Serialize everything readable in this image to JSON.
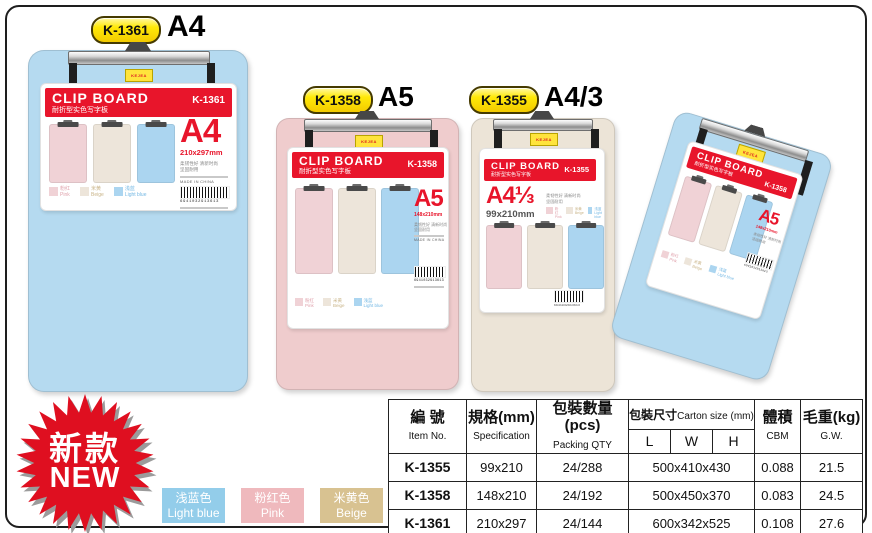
{
  "brand": {
    "logo_text": "KEJEA"
  },
  "products": [
    {
      "badge": "K-1361",
      "size_label": "A4",
      "board_color": "#b5daf0",
      "label": {
        "title": "CLIP BOARD",
        "subtitle": "耐折型实色写字板",
        "code": "K-1361",
        "size": "A4",
        "dimensions": "210x297mm",
        "feature_line1": "柔韧性好  清新时尚",
        "feature_line2": "坚固耐用",
        "made_in": "MADE IN CHINA",
        "barcode": "6941032913613",
        "swatches": [
          {
            "cn": "粉红",
            "en": "Pink",
            "color": "#f0d2d6",
            "text_color": "#e0a3ad"
          },
          {
            "cn": "米黄",
            "en": "Beige",
            "color": "#ede5da",
            "text_color": "#c9b488"
          },
          {
            "cn": "浅蓝",
            "en": "Light blue",
            "color": "#abd5f0",
            "text_color": "#74b8e4"
          }
        ]
      }
    },
    {
      "badge": "K-1358",
      "size_label": "A5",
      "board_color": "#efcccd",
      "label": {
        "title": "CLIP BOARD",
        "subtitle": "耐折型实色写字板",
        "code": "K-1358",
        "size": "A5",
        "dimensions": "148x210mm",
        "feature_line1": "柔韧性好  清新时尚",
        "feature_line2": "坚固耐用",
        "made_in": "MADE IN CHINA",
        "barcode": "6941032913613",
        "swatches": [
          {
            "cn": "粉红",
            "en": "Pink",
            "color": "#f0d2d6",
            "text_color": "#e0a3ad"
          },
          {
            "cn": "米黄",
            "en": "Beige",
            "color": "#ede5da",
            "text_color": "#c9b488"
          },
          {
            "cn": "浅蓝",
            "en": "Light blue",
            "color": "#abd5f0",
            "text_color": "#74b8e4"
          }
        ]
      }
    },
    {
      "badge": "K-1355",
      "size_label": "A4/3",
      "board_color": "#ece4d7",
      "label": {
        "title": "CLIP BOARD",
        "subtitle": "耐折型实色写字板",
        "code": "K-1355",
        "size": "A4⅓",
        "dimensions": "99x210mm",
        "feature_line1": "柔韧性好  清新时尚",
        "feature_line2": "坚固耐用",
        "made_in": "MADE IN CHINA",
        "barcode": "6941032913613",
        "swatches": [
          {
            "cn": "粉红",
            "en": "Pink",
            "color": "#f0d2d6",
            "text_color": "#e0a3ad"
          },
          {
            "cn": "米黄",
            "en": "Beige",
            "color": "#ede5da",
            "text_color": "#c9b488"
          },
          {
            "cn": "浅蓝",
            "en": "Light blue",
            "color": "#abd5f0",
            "text_color": "#74b8e4"
          }
        ]
      }
    },
    {
      "board_color": "#b5daf0",
      "label": {
        "title": "CLIP BOARD",
        "subtitle": "耐折型实色写字板",
        "code": "K-1358",
        "size": "A5",
        "dimensions": "148x210mm",
        "feature_line1": "柔韧性好  清新时尚",
        "feature_line2": "坚固耐用",
        "made_in": "MADE IN CHINA",
        "barcode": "6941032913613",
        "swatches": [
          {
            "cn": "粉红",
            "en": "Pink",
            "color": "#f0d2d6",
            "text_color": "#e0a3ad"
          },
          {
            "cn": "米黄",
            "en": "Beige",
            "color": "#ede5da",
            "text_color": "#c9b488"
          },
          {
            "cn": "浅蓝",
            "en": "Light blue",
            "color": "#abd5f0",
            "text_color": "#74b8e4"
          }
        ]
      }
    }
  ],
  "new_badge": {
    "line1": "新款",
    "line2": "NEW",
    "star_color": "#df0f20"
  },
  "legend": [
    {
      "cn": "浅蓝色",
      "en": "Light blue",
      "color": "#93cdea"
    },
    {
      "cn": "粉红色",
      "en": "Pink",
      "color": "#efb9bd"
    },
    {
      "cn": "米黄色",
      "en": "Beige",
      "color": "#d8c291"
    }
  ],
  "table": {
    "headers": {
      "item_cn": "編  號",
      "item_en": "Item No.",
      "spec_cn": "規格(mm)",
      "spec_en": "Specification",
      "qty_cn": "包裝數量(pcs)",
      "qty_en": "Packing QTY",
      "carton_cn": "包裝尺寸",
      "carton_en": "Carton size (mm)",
      "l": "L",
      "w": "W",
      "h": "H",
      "vol_cn": "體積",
      "vol_en": "CBM",
      "gw_cn": "毛重(kg)",
      "gw_en": "G.W."
    },
    "rows": [
      {
        "item": "K-1355",
        "spec": "99x210",
        "qty": "24/288",
        "carton": "500x410x430",
        "cbm": "0.088",
        "gw": "21.5"
      },
      {
        "item": "K-1358",
        "spec": "148x210",
        "qty": "24/192",
        "carton": "500x450x370",
        "cbm": "0.083",
        "gw": "24.5"
      },
      {
        "item": "K-1361",
        "spec": "210x297",
        "qty": "24/144",
        "carton": "600x342x525",
        "cbm": "0.108",
        "gw": "27.6"
      }
    ]
  }
}
